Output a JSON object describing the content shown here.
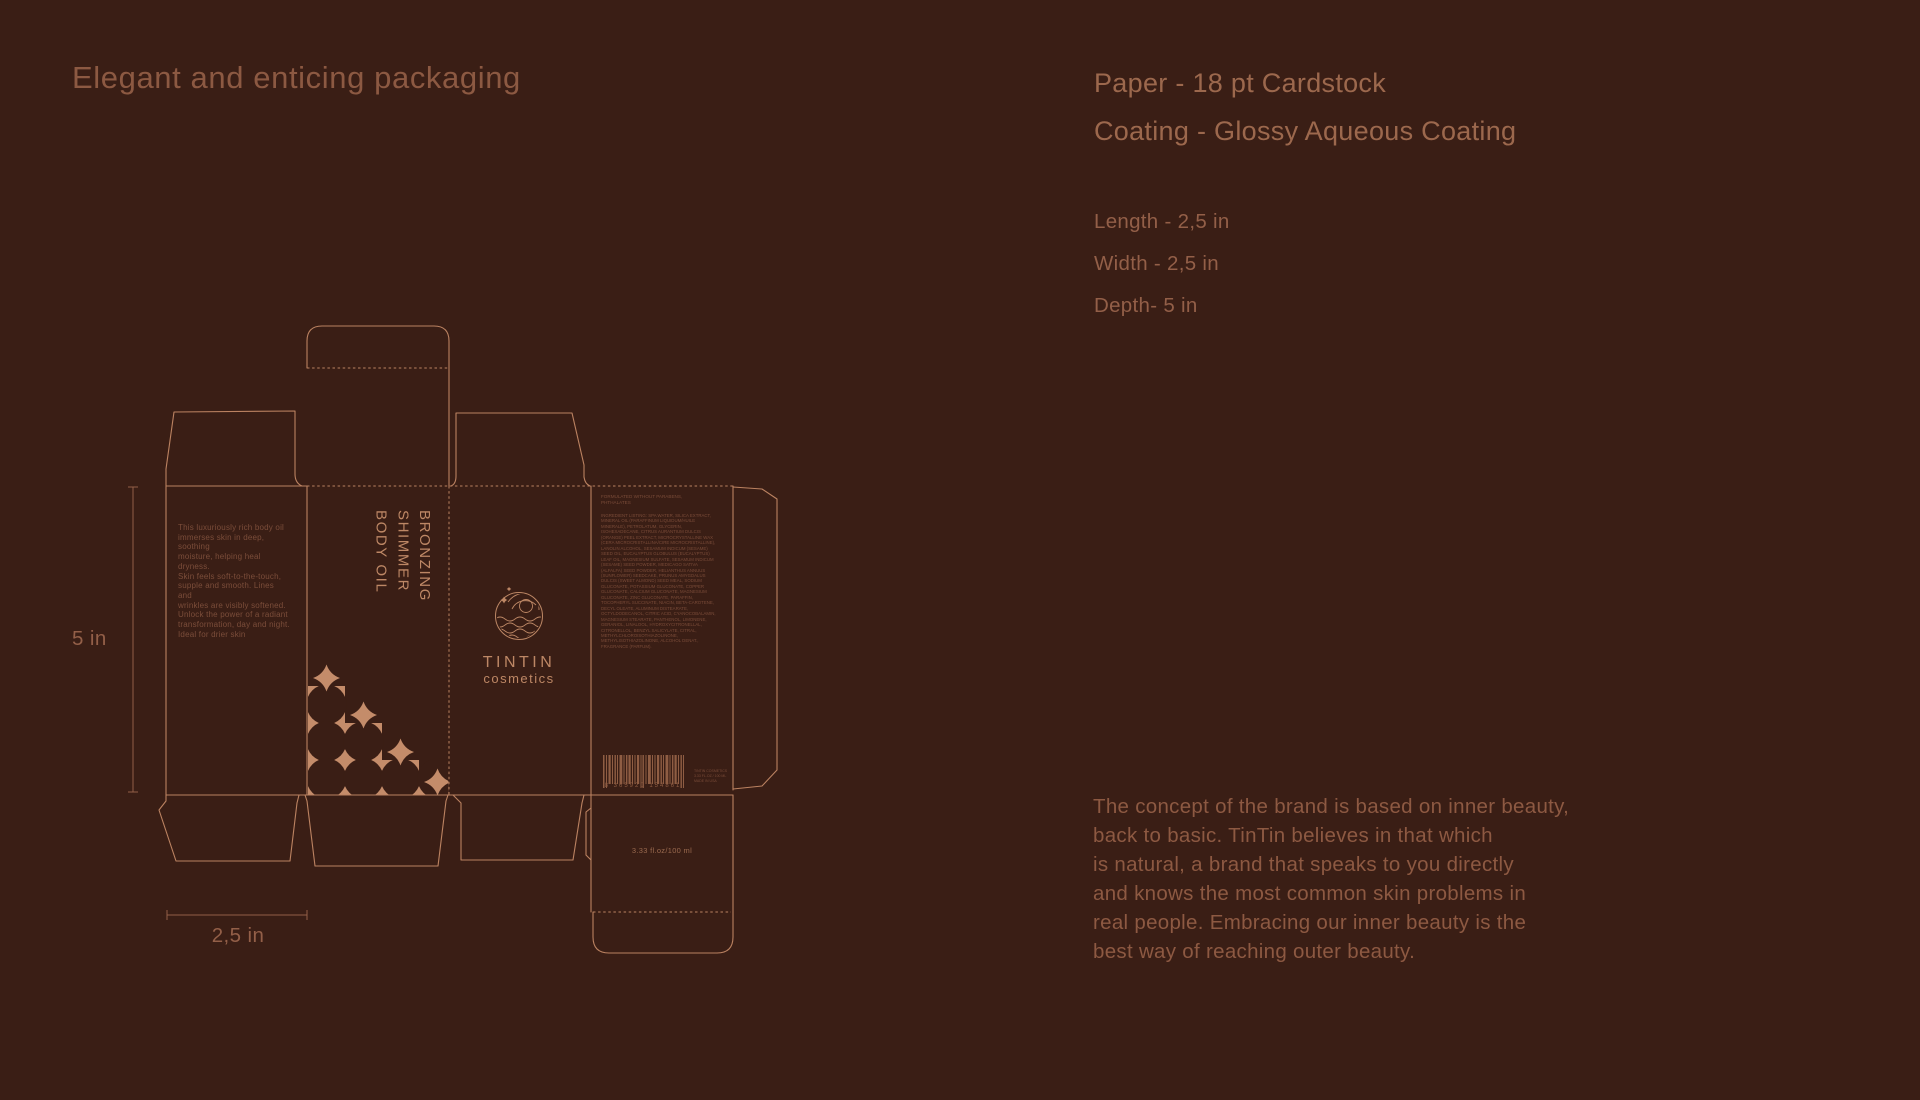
{
  "page": {
    "background": "#3a1e15",
    "line_color": "#bb8261",
    "pattern_color": "#c48c6a"
  },
  "header": {
    "title": "Elegant and enticing packaging"
  },
  "specs": {
    "paper": "Paper - 18 pt Cardstock",
    "coating": "Coating - Glossy Aqueous Coating",
    "dimensions": [
      "Length - 2,5 in",
      "Width - 2,5 in",
      "Depth- 5 in"
    ]
  },
  "brand_paragraph": "The concept of the brand is based on inner beauty,\nback to basic. TinTin believes in that which\nis natural, a brand that speaks to you directly\nand knows the most common skin problems in\nreal people. Embracing our inner beauty is the\nbest way of reaching outer beauty.",
  "dieline": {
    "dimension_labels": {
      "depth": "5 in",
      "width": "2,5 in"
    },
    "side_panel_copy": "This luxuriously rich body oil\nimmerses skin in deep, soothing\nmoisture, helping heal dryness.\nSkin feels soft-to-the-touch,\nsupple and smooth. Lines and\nwrinkles are visibly softened.\nUnlock the power of a radiant\ntransformation, day and night.\nIdeal for drier skin",
    "front_panel": {
      "product_name": "BRONZING\nSHIMMER\nBODY OIL"
    },
    "logo": {
      "name": "TINTIN",
      "subtitle": "cosmetics"
    },
    "back_panel": {
      "claims": "FORMULATED WITHOUT PARABENS,\nPHTHALATES",
      "ingredients": "INGREDIENT LISTING: SPA WATER, SILICA EXTRACT, MINERAL OIL (PARAFFINUM LIQUIDUM/HUILE MINERALE), PETROLATUM, GLYCERIN, ISOHEXADECANE, CITRUS AURANTIUM DULCIS (ORANGE) PEEL EXTRACT, MICROCRYSTALLINE WAX (CERA MICROCRISTALLINA/CIRE MICROCRISTALLINE), LANOLIN ALCOHOL, SESAMUM INDICUM (SESAME) SEED OIL, EUCALYPTUS GLOBULUS (EUCALYPTUS) LEAF OIL, MAGNESIUM SULFATE, SESAMUM INDICUM (SESAME) SEED POWDER, MEDICAGO SATIVA (ALFALFA) SEED POWDER, HELIANTHUS ANNUUS (SUNFLOWER) SEEDCAKE, PRUNUS AMYGDALUS DULCIS (SWEET ALMOND) SEED MEAL, SODIUM GLUCONATE, POTASSIUM GLUCONATE, COPPER GLUCONATE, CALCIUM GLUCONATE, MAGNESIUM GLUCONATE, ZINC GLUCONATE, PARAFFIN, TOCOPHERYL SUCCINATE, NIACIN, BETA-CAROTENE, DECYL OLEATE, ALUMINUM DISTEARATE, OCTYLDODECANOL, CITRIC ACID, CYANOCOBALAMIN, MAGNESIUM STEARATE, PANTHENOL, LIMONENE, GERANIOL, LINALOOL, HYDROXYCITRONELLAL, CITRONELLOL, BENZYL SALICYLATE, CITRAL, METHYLCHLOROISOTHIAZOLINONE, METHYLISOTHIAZOLINONE, ALCOHOL DENAT., FRAGRANCE (PARFUM).",
      "volume": "3.33 fl.oz/100 ml",
      "barcode_digits": "8 365920 154861",
      "distributor_lines": "TINTIN COSMETICS\n3.33 FL.OZ / 100 ML\nMADE IN USA"
    }
  }
}
